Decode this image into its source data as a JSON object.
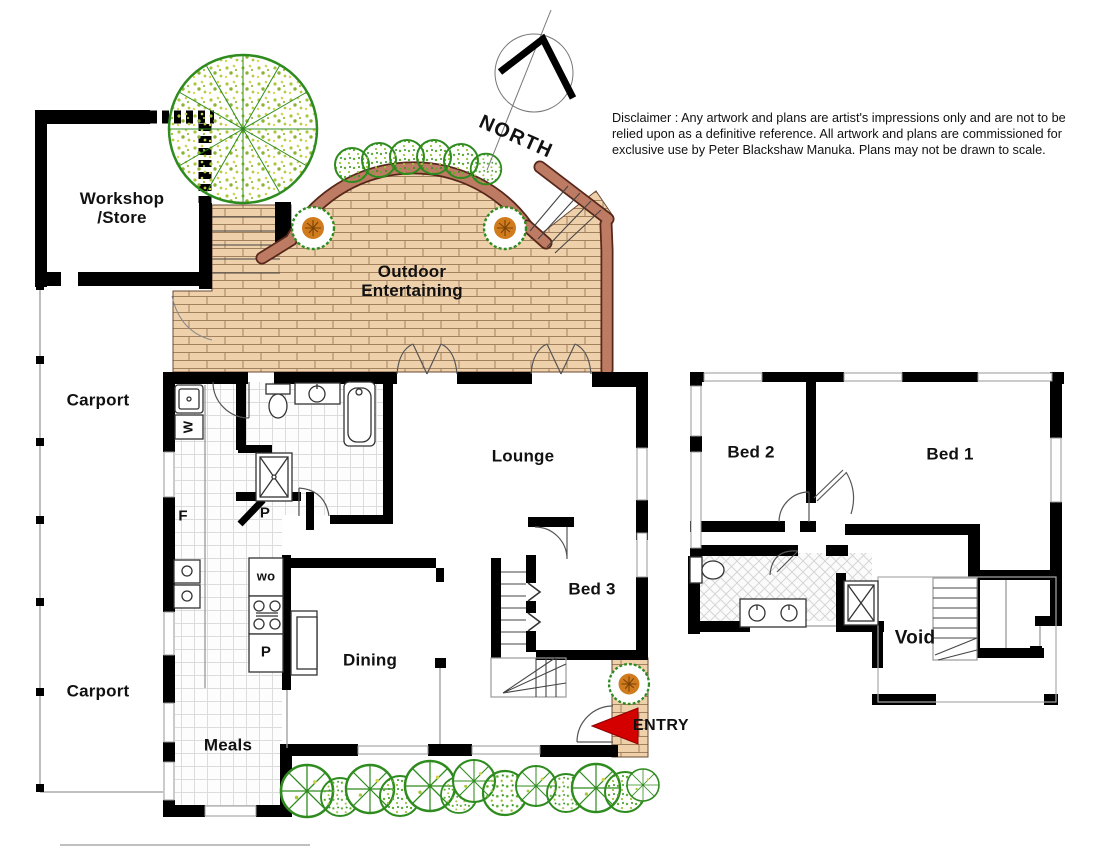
{
  "north": {
    "label": "NORTH"
  },
  "disclaimer": {
    "text": "Disclaimer : Any artwork and plans are artist's impressions only and are not to be relied upon as a definitive reference. All artwork and plans are commissioned for exclusive use by Peter Blackshaw Manuka. Plans may not be drawn to scale."
  },
  "ground_floor": {
    "workshop_label_line1": "Workshop",
    "workshop_label_line2": "/Store",
    "carport_upper_label": "Carport",
    "carport_lower_label": "Carport",
    "outdoor_label_line1": "Outdoor",
    "outdoor_label_line2": "Entertaining",
    "lounge_label": "Lounge",
    "bed3_label": "Bed 3",
    "dining_label": "Dining",
    "meals_label": "Meals",
    "entry_label": "ENTRY",
    "fixtures": {
      "washing_machine": "W",
      "fridge": "F",
      "pantry_upper": "P",
      "wall_oven": "wo",
      "pantry_lower": "P"
    }
  },
  "upper_floor": {
    "bed2_label": "Bed 2",
    "bed1_label": "Bed 1",
    "void_label": "Void"
  },
  "colors": {
    "wall_black": "#000000",
    "brick_fill": "#eed0ab",
    "brick_line": "#a2815f",
    "garden_wall": "#bd7b63",
    "garden_wall_edge": "#57281a",
    "tree_green": "#2e8b1e",
    "foliage_dot": "#b6cc3a",
    "bush_orange": "#d07b1d",
    "entry_red": "#d40000"
  }
}
